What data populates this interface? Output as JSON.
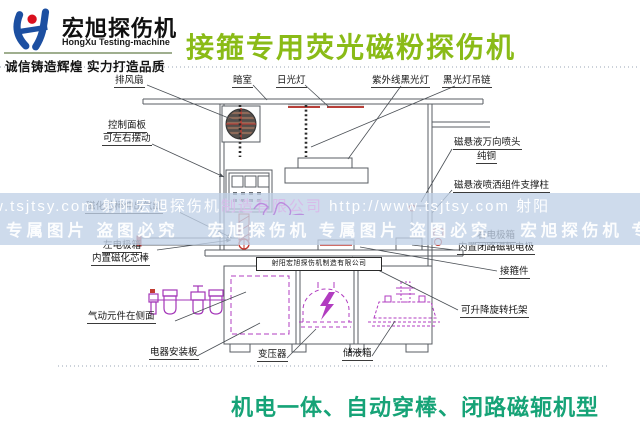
{
  "logo": {
    "brand_cn": "宏旭探伤机",
    "brand_en": "HongXu Testing-machine",
    "tagline": "诚信铸造辉煌  实力打造品质"
  },
  "title": "接箍专用荧光磁粉探伤机",
  "footer_caption": "机电一体、自动穿棒、闭路磁轭机型",
  "nameplate": "射阳宏旭探伤机制造有限公司",
  "watermark": {
    "line1a": "w.tsjtsy.com  射阳宏旭探伤机",
    "line1b": "制造有限公司",
    "line1c": "   http://www.tsjtsy.com  射阳",
    "line2": "专属图片 盗图必究　 宏旭探伤机 专属图片 盗图必究　 宏旭探伤机 专属图片"
  },
  "labels": {
    "exhaust_fan": "排风扇",
    "darkroom": "暗室",
    "fluorescent_lamp": "日光灯",
    "uv_black_lamp": "紫外线黑光灯",
    "black_lamp_chain": "黑光灯吊链",
    "control_panel": "控制面板",
    "control_panel_sub": "可左右摆动",
    "rod_cylinder": "磁化芯棒伸出气缸",
    "left_electrode_box": "左电极箱",
    "left_electrode_box_sub": "内置磁化芯棒",
    "pneumatic": "气动元件在侧面",
    "electrical_board": "电器安装板",
    "transformer": "变压器",
    "liquid_tank": "储液箱",
    "nozzle": "磁悬液万向喷头",
    "nozzle_sub": "纯铜",
    "spray_column": "磁悬液喷洒组件支撑柱",
    "right_electrode_box": "右电极箱",
    "right_electrode_box_sub": "内置闭路磁轭电极",
    "coupling": "接箍件",
    "rotating_bracket": "可升降旋转托架"
  },
  "colors": {
    "title_green": "#8abb17",
    "caption_teal": "#16a377",
    "watermark_band": "#c0d1e7",
    "magenta_parts": "#b13cc0",
    "red_parts": "#c23b32",
    "logo_blue": "#1c4fa1",
    "logo_dot_red": "#d90f1e",
    "line_gray": "#585d63"
  }
}
